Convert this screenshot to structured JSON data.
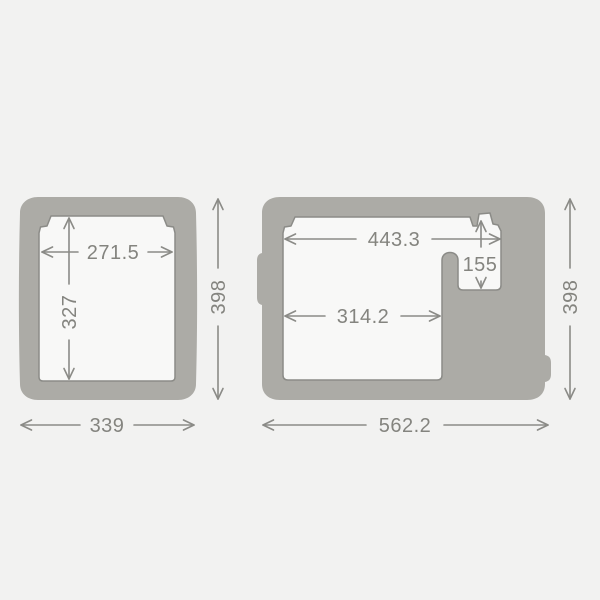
{
  "diagram": {
    "type": "technical-dimension-drawing",
    "subject": "cooler cross-section dimension diagram, two views",
    "background_color": "#f2f2f1",
    "body_color": "#acaba6",
    "cavity_color": "#f8f8f7",
    "line_color": "#8b8b87",
    "text_color": "#84847f",
    "views": {
      "left": {
        "name": "side cross-section",
        "labels": {
          "inner_width": "271.5",
          "inner_height": "327",
          "outer_height": "398",
          "outer_width": "339"
        }
      },
      "right": {
        "name": "front cross-section",
        "labels": {
          "opening_width": "443.3",
          "compartment_depth": "155",
          "main_width": "314.2",
          "outer_height": "398",
          "outer_width": "562.2"
        }
      }
    }
  }
}
